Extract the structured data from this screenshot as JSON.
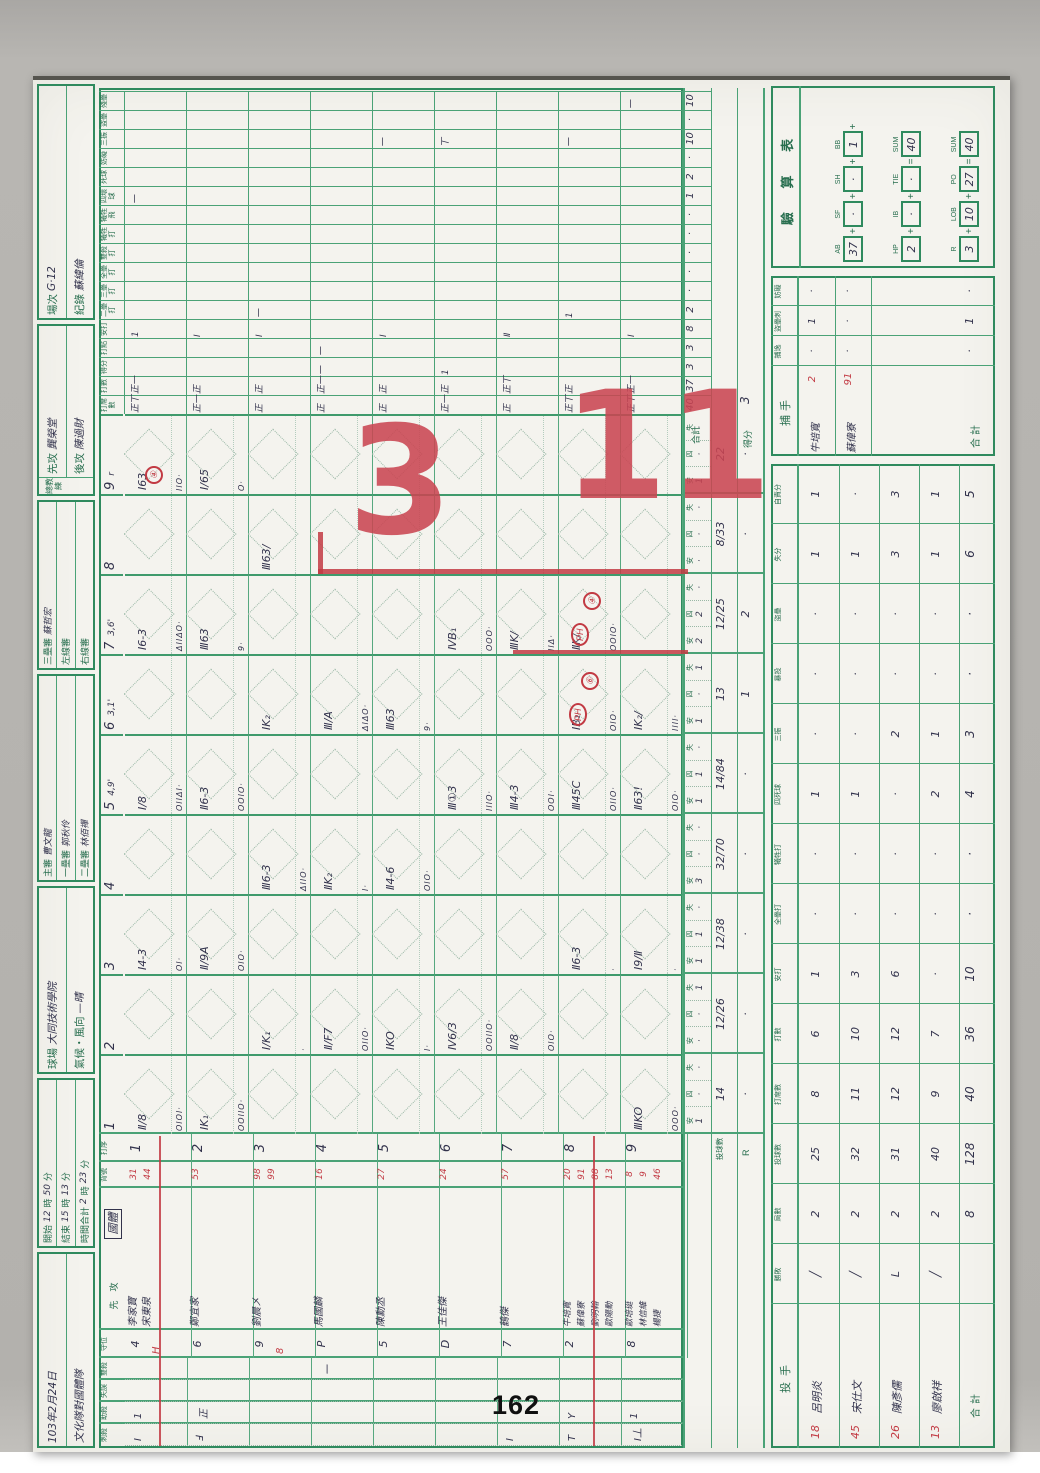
{
  "page": {
    "number": "162"
  },
  "colors": {
    "grid_green": "#2f8a5e",
    "printed_green": "#276e4e",
    "ink": "#32324c",
    "red": "#c23a43",
    "paper": "#f4f3ee"
  },
  "header": {
    "groups": [
      {
        "rows": [
          [
            [
              "103年2月24日",
              "h"
            ]
          ],
          [
            [
              "文化隊對國體隊",
              "h"
            ]
          ]
        ]
      },
      {
        "rows": [
          [
            [
              "開始",
              "p"
            ],
            [
              "12",
              "h"
            ],
            [
              "時",
              "p"
            ],
            [
              "50",
              "h"
            ],
            [
              "分",
              "p"
            ]
          ],
          [
            [
              "結束",
              "p"
            ],
            [
              "15",
              "h"
            ],
            [
              "時",
              "p"
            ],
            [
              "13",
              "h"
            ],
            [
              "分",
              "p"
            ]
          ],
          [
            [
              "時間合計",
              "p"
            ],
            [
              "2",
              "h"
            ],
            [
              "時",
              "p"
            ],
            [
              "23",
              "h"
            ],
            [
              "分",
              "p"
            ]
          ]
        ]
      },
      {
        "rows": [
          [
            [
              "球場",
              "p"
            ],
            [
              "大同技術學院",
              "h"
            ]
          ],
          [
            [
              "氣候・風向",
              "p"
            ],
            [
              "—晴",
              "h"
            ]
          ]
        ]
      },
      {
        "rows": [
          [
            [
              "主審",
              "p"
            ],
            [
              "曹文龍",
              "h"
            ]
          ],
          [
            [
              "一壘審",
              "p"
            ],
            [
              "郭秋伶",
              "h"
            ]
          ],
          [
            [
              "二壘審",
              "p"
            ],
            [
              "林佰禪",
              "h"
            ]
          ]
        ]
      },
      {
        "rows": [
          [
            [
              "三壘審",
              "p"
            ],
            [
              "蘇哲宏",
              "h"
            ]
          ],
          [
            [
              "左線審",
              "p"
            ]
          ],
          [
            [
              "右線審",
              "p"
            ]
          ]
        ]
      },
      {
        "side": "總教練",
        "rows": [
          [
            [
              "先攻",
              "p"
            ],
            [
              "龔榮堂",
              "h"
            ]
          ],
          [
            [
              "後攻",
              "p"
            ],
            [
              "陳過財",
              "h"
            ]
          ]
        ]
      },
      {
        "rows": [
          [
            [
              "場次",
              "p"
            ],
            [
              "G·12",
              "h"
            ]
          ],
          [
            [
              "紀錄",
              "p"
            ],
            [
              "蘇緯倫",
              "h"
            ]
          ]
        ]
      }
    ]
  },
  "grid": {
    "left_headers": [
      "刺殺",
      "助殺",
      "失誤",
      "雙殺",
      "守位"
    ],
    "name_header": {
      "printed": "先　攻",
      "team": "國體"
    },
    "number_header": "背號",
    "order_header": "打序",
    "innings": [
      {
        "n": "1"
      },
      {
        "n": "2"
      },
      {
        "n": "3"
      },
      {
        "n": "4"
      },
      {
        "n": "5",
        "note": "4,9'"
      },
      {
        "n": "6",
        "note": "3,1'"
      },
      {
        "n": "7",
        "note": "3,6'"
      },
      {
        "n": "8"
      },
      {
        "n": "9",
        "note": "r"
      }
    ],
    "batters": [
      {
        "order": "1",
        "pos": "4",
        "pos_sub": "H",
        "subline": true,
        "players": [
          {
            "name": "李家寶",
            "no": "31"
          },
          {
            "name": "宋東泉",
            "no": "44",
            "red": true
          }
        ]
      },
      {
        "order": "2",
        "pos": "6",
        "players": [
          {
            "name": "鄭宜家",
            "no": "53"
          }
        ]
      },
      {
        "order": "3",
        "pos": "9",
        "pos_sub": "8",
        "players": [
          {
            "name": "劉晨㐅",
            "no": "98"
          },
          {
            "name": "",
            "no": "99",
            "red": true
          }
        ]
      },
      {
        "order": "4",
        "pos": "P",
        "players": [
          {
            "name": "馬國麟",
            "no": "16"
          }
        ]
      },
      {
        "order": "5",
        "pos": "5",
        "players": [
          {
            "name": "陳勳丞",
            "no": "27"
          }
        ]
      },
      {
        "order": "6",
        "pos": "D",
        "players": [
          {
            "name": "王佳傑",
            "no": "24"
          }
        ]
      },
      {
        "order": "7",
        "pos": "7",
        "players": [
          {
            "name": "鶴傑",
            "no": "57"
          }
        ]
      },
      {
        "order": "8",
        "pos": "2",
        "subline": true,
        "players": [
          {
            "name": "牛培寬",
            "no": "20"
          },
          {
            "name": "蘇偉寮",
            "no": "91",
            "red": true
          },
          {
            "name": "劉明翰",
            "no": "88",
            "red": true
          },
          {
            "name": "歐陽勳",
            "no": "13",
            "red": true
          }
        ]
      },
      {
        "order": "9",
        "pos": "8",
        "players": [
          {
            "name": "歐培珽",
            "no": "8"
          },
          {
            "name": "林信維",
            "no": "9"
          },
          {
            "name": "楊捷",
            "no": "46",
            "red": true
          }
        ]
      }
    ],
    "def_marks": [
      {
        "b": 1,
        "c": 0,
        "t": "Ⅰ"
      },
      {
        "b": 1,
        "c": 1,
        "t": "1"
      },
      {
        "b": 2,
        "c": 0,
        "t": "Ⅎ"
      },
      {
        "b": 2,
        "c": 1,
        "t": "正"
      },
      {
        "b": 4,
        "c": 3,
        "t": "一"
      },
      {
        "b": 7,
        "c": 0,
        "t": "Ⅰ"
      },
      {
        "b": 8,
        "c": 0,
        "t": "T"
      },
      {
        "b": 8,
        "c": 1,
        "t": "Y"
      },
      {
        "b": 9,
        "c": 0,
        "t": "Ⅰ丄"
      },
      {
        "b": 9,
        "c": 1,
        "t": "1"
      }
    ],
    "marks": [
      {
        "b": 1,
        "i": 1,
        "m": "Ⅱ/8",
        "p": "OIOI·"
      },
      {
        "b": 1,
        "i": 3,
        "m": "Ⅰ4-3",
        "p": "OI·"
      },
      {
        "b": 1,
        "i": 5,
        "m": "Ⅰ/8",
        "p": "OIIΔI·"
      },
      {
        "b": 1,
        "i": 7,
        "m": "Ⅰ6-3",
        "p": "ΔIIΔO·"
      },
      {
        "b": 1,
        "i": 9,
        "m": "Ⅰ63",
        "p": "IIO·"
      },
      {
        "b": 2,
        "i": 1,
        "m": "ⅠK₁",
        "p": "OOIIO·"
      },
      {
        "b": 2,
        "i": 3,
        "m": "Ⅱ/9A",
        "p": "OIO·"
      },
      {
        "b": 2,
        "i": 5,
        "m": "Ⅱ6-3",
        "p": "OOIO·"
      },
      {
        "b": 2,
        "i": 7,
        "m": "Ⅲ63",
        "p": "9·"
      },
      {
        "b": 2,
        "i": 9,
        "m": "Ⅰ/65",
        "p": "O·"
      },
      {
        "b": 3,
        "i": 2,
        "m": "Ⅰ/K₁",
        "p": "·"
      },
      {
        "b": 3,
        "i": 4,
        "m": "Ⅲ6-3",
        "p": "ΔIIO·"
      },
      {
        "b": 3,
        "i": 6,
        "m": "ⅠK₂",
        "p": ""
      },
      {
        "b": 3,
        "i": 8,
        "m": "Ⅲ63/",
        "p": ""
      },
      {
        "b": 4,
        "i": 2,
        "m": "Ⅱ/F7",
        "p": "OIIO·"
      },
      {
        "b": 4,
        "i": 4,
        "m": "ⅡK₂",
        "p": "I·"
      },
      {
        "b": 4,
        "i": 6,
        "m": "Ⅲ/A",
        "p": "ΔIΔO·"
      },
      {
        "b": 5,
        "i": 2,
        "m": "ⅠKO",
        "p": "I·"
      },
      {
        "b": 5,
        "i": 4,
        "m": "Ⅱ4-6",
        "p": "OIO·"
      },
      {
        "b": 5,
        "i": 6,
        "m": "Ⅲ63",
        "p": "9·"
      },
      {
        "b": 6,
        "i": 2,
        "m": "Ⅳ6/3",
        "p": "OOIIO·"
      },
      {
        "b": 6,
        "i": 5,
        "m": "Ⅲ①3",
        "p": "IIIO·"
      },
      {
        "b": 6,
        "i": 7,
        "m": "ⅣB₁",
        "p": "OOO·"
      },
      {
        "b": 7,
        "i": 2,
        "m": "Ⅱ/8",
        "p": "OIO·"
      },
      {
        "b": 7,
        "i": 5,
        "m": "Ⅲ4-3",
        "p": "OOI·"
      },
      {
        "b": 7,
        "i": 7,
        "m": "ⅢK/",
        "p": "IIΔ·"
      },
      {
        "b": 8,
        "i": 3,
        "m": "Ⅱ6-3",
        "p": "·"
      },
      {
        "b": 8,
        "i": 5,
        "m": "Ⅲ45C",
        "p": "OIIO·"
      },
      {
        "b": 8,
        "i": 6,
        "m": "ⅠB₁",
        "p": "OIO·"
      },
      {
        "b": 8,
        "i": 7,
        "m": "ⅡK/",
        "p": "OOIO·"
      },
      {
        "b": 9,
        "i": 1,
        "m": "ⅢKO",
        "p": "OOO·"
      },
      {
        "b": 9,
        "i": 3,
        "m": "Ⅰ9/Ⅱ",
        "p": "·"
      },
      {
        "b": 9,
        "i": 5,
        "m": "Ⅱ63!",
        "p": "OIO·"
      },
      {
        "b": 9,
        "i": 6,
        "m": "ⅠK₂/",
        "p": "IIII·"
      }
    ],
    "red_circles": [
      {
        "t": "PH"
      },
      {
        "t": "⑥"
      },
      {
        "t": "PH"
      },
      {
        "t": "④"
      },
      {
        "t": "④"
      }
    ],
    "stat_cols": [
      "打席數",
      "打數",
      "得分",
      "打點",
      "安打",
      "二壘打",
      "三壘打",
      "全壘打",
      "雙殺打",
      "犧牲打",
      "犧牲飛",
      "四壞球",
      "死球",
      "妨礙",
      "三振",
      "盜壘",
      "殘壘"
    ],
    "stat_marks": [
      {
        "b": 1,
        "c": 0,
        "t": "正丅"
      },
      {
        "b": 1,
        "c": 1,
        "t": "正一"
      },
      {
        "b": 1,
        "c": 4,
        "t": "1"
      },
      {
        "b": 1,
        "c": 11,
        "t": "一"
      },
      {
        "b": 2,
        "c": 0,
        "t": "正一"
      },
      {
        "b": 2,
        "c": 1,
        "t": "正"
      },
      {
        "b": 2,
        "c": 4,
        "t": "Ⅰ"
      },
      {
        "b": 3,
        "c": 0,
        "t": "正"
      },
      {
        "b": 3,
        "c": 1,
        "t": "正"
      },
      {
        "b": 3,
        "c": 5,
        "t": "一"
      },
      {
        "b": 3,
        "c": 4,
        "t": "Ⅰ"
      },
      {
        "b": 4,
        "c": 0,
        "t": "正"
      },
      {
        "b": 4,
        "c": 1,
        "t": "正一"
      },
      {
        "b": 4,
        "c": 2,
        "t": "一"
      },
      {
        "b": 4,
        "c": 3,
        "t": "一"
      },
      {
        "b": 5,
        "c": 0,
        "t": "正"
      },
      {
        "b": 5,
        "c": 1,
        "t": "正"
      },
      {
        "b": 5,
        "c": 4,
        "t": "Ⅰ"
      },
      {
        "b": 5,
        "c": 14,
        "t": "一"
      },
      {
        "b": 6,
        "c": 0,
        "t": "正一"
      },
      {
        "b": 6,
        "c": 1,
        "t": "正"
      },
      {
        "b": 6,
        "c": 2,
        "t": "1"
      },
      {
        "b": 6,
        "c": 14,
        "t": "丅"
      },
      {
        "b": 7,
        "c": 0,
        "t": "正"
      },
      {
        "b": 7,
        "c": 1,
        "t": "正丅"
      },
      {
        "b": 7,
        "c": 4,
        "t": "Ⅱ"
      },
      {
        "b": 8,
        "c": 0,
        "t": "正丅"
      },
      {
        "b": 8,
        "c": 1,
        "t": "正"
      },
      {
        "b": 8,
        "c": 5,
        "t": "1"
      },
      {
        "b": 8,
        "c": 14,
        "t": "一"
      },
      {
        "b": 9,
        "c": 0,
        "t": "正丅"
      },
      {
        "b": 9,
        "c": 1,
        "t": "正一"
      },
      {
        "b": 9,
        "c": 4,
        "t": "Ⅰ"
      },
      {
        "b": 9,
        "c": 16,
        "t": "一"
      }
    ],
    "stat_totals": [
      "40",
      "37",
      "3",
      "3",
      "8",
      "2",
      "·",
      "·",
      "·",
      "·",
      "·",
      "1",
      "2",
      "·",
      "10",
      "·",
      "10"
    ],
    "totals_label": "合計",
    "summary_labels": [
      "安",
      "四",
      "失"
    ],
    "summary": [
      [
        "1",
        "·",
        "·"
      ],
      [
        "·",
        "·",
        "1"
      ],
      [
        "1",
        "1",
        "·"
      ],
      [
        "3",
        "·",
        "·"
      ],
      [
        "1",
        "1",
        "·"
      ],
      [
        "1",
        "·",
        "1"
      ],
      [
        "2",
        "2",
        "·"
      ],
      [
        "·",
        "·",
        "·"
      ],
      [
        "1",
        "·",
        "·"
      ]
    ],
    "pitch_row": {
      "label": "投球數",
      "values": [
        "14",
        "12/26",
        "12/38",
        "32/70",
        "14/84",
        "13",
        "12/25",
        "8/33",
        "22"
      ]
    },
    "run_row": {
      "label": "R",
      "values": [
        "·",
        "·",
        "·",
        "·",
        "·",
        "1",
        "2",
        "·",
        "·"
      ],
      "total_label": "得分",
      "total": "3"
    },
    "big_score": [
      "3",
      "11"
    ]
  },
  "pitchers": {
    "title": "投手",
    "cols": [
      "勝敗",
      "局數",
      "投球數",
      "打席數",
      "打數",
      "安打",
      "全壘打",
      "犧牲打",
      "四死球",
      "三振",
      "暴投",
      "盜壘",
      "失分",
      "自責分"
    ],
    "rows": [
      {
        "no": "18",
        "name": "呂明炎",
        "v": [
          "╱",
          "2",
          "25",
          "8",
          "6",
          "1",
          "·",
          "·",
          "1",
          "·",
          "·",
          "·",
          "1",
          "1"
        ]
      },
      {
        "no": "45",
        "name": "宋仕文",
        "v": [
          "╱",
          "2",
          "32",
          "11",
          "10",
          "3",
          "·",
          "·",
          "1",
          "·",
          "·",
          "·",
          "1",
          "·"
        ]
      },
      {
        "no": "26",
        "name": "陳彥儒",
        "v": [
          "L",
          "2",
          "31",
          "12",
          "12",
          "6",
          "·",
          "·",
          "·",
          "2",
          "·",
          "·",
          "3",
          "3"
        ]
      },
      {
        "no": "13",
        "name": "廖啟祥",
        "v": [
          "╱",
          "2",
          "40",
          "9",
          "7",
          "·",
          "·",
          "·",
          "2",
          "1",
          "·",
          "·",
          "1",
          "1"
        ]
      }
    ],
    "total_label": "合計",
    "total": [
      "",
      "8",
      "128",
      "40",
      "36",
      "10",
      "·",
      "·",
      "4",
      "3",
      "·",
      "·",
      "6",
      "5"
    ]
  },
  "catchers": {
    "title": "捕手",
    "cols": [
      "捕逸",
      "盜壘刺",
      "妨礙"
    ],
    "rows": [
      {
        "no": "2",
        "name": "牛培寬",
        "v": [
          "·",
          "1",
          "·"
        ]
      },
      {
        "no": "91",
        "name": "蘇偉寮",
        "v": [
          "·",
          "·",
          "·"
        ]
      }
    ],
    "total_label": "合計",
    "total": [
      "·",
      "1",
      "·"
    ]
  },
  "check": {
    "title": "驗 算 表",
    "rows": [
      {
        "cells": [
          [
            "AB",
            "37"
          ],
          [
            "SF",
            "·"
          ],
          [
            "SH",
            "·"
          ],
          [
            "BB",
            "1"
          ]
        ],
        "tail": "+"
      },
      {
        "cells": [
          [
            "HP",
            "2"
          ],
          [
            "IB",
            "·"
          ],
          [
            "TIE",
            "·"
          ]
        ],
        "eq": [
          "SUM",
          "40"
        ]
      },
      {
        "cells": [
          [
            "R",
            "3"
          ],
          [
            "LOB",
            "10"
          ],
          [
            "PO",
            "27"
          ]
        ],
        "eq": [
          "SUM",
          "40"
        ]
      }
    ]
  }
}
